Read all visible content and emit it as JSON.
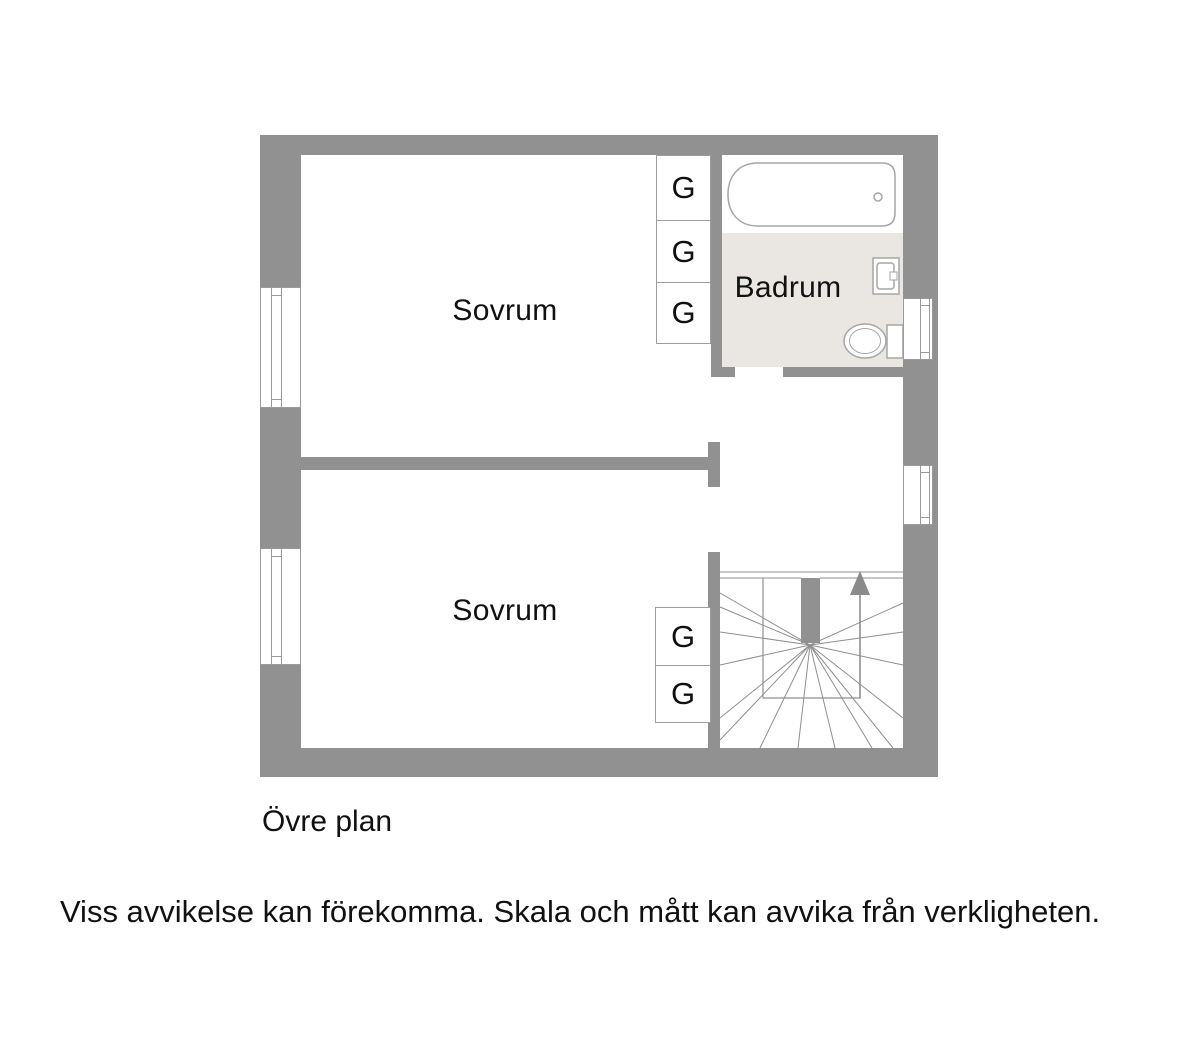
{
  "plan": {
    "floor_label": "Övre plan",
    "disclaimer": "Viss avvikelse kan förekomma. Skala och mått kan avvika från verkligheten.",
    "rooms": [
      {
        "id": "bedroom-top",
        "label": "Sovrum"
      },
      {
        "id": "bedroom-bottom",
        "label": "Sovrum"
      },
      {
        "id": "bathroom",
        "label": "Badrum"
      }
    ],
    "closets": [
      {
        "label": "G"
      },
      {
        "label": "G"
      },
      {
        "label": "G"
      },
      {
        "label": "G"
      },
      {
        "label": "G"
      }
    ],
    "fixtures": [
      "bathtub",
      "sink",
      "toilet",
      "winder-staircase",
      "stairs-up-arrow"
    ],
    "windows_count": 4,
    "colors": {
      "wall": "#919191",
      "bathroom_floor": "#eae7e2",
      "fixture_outline": "#a6a6a6",
      "stair_line": "#8f8f8f",
      "landing_line": "#c9c9c9",
      "text": "#111111"
    }
  }
}
